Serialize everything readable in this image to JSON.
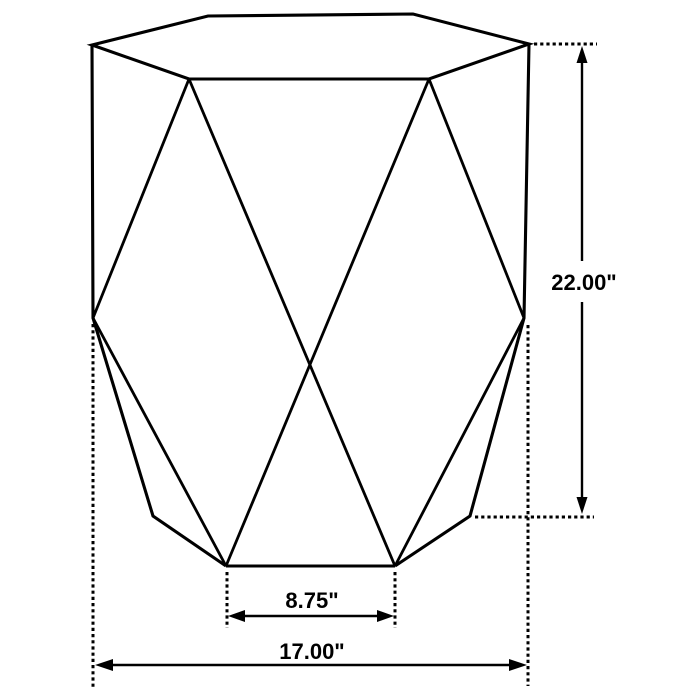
{
  "diagram": {
    "type": "product dimension drawing",
    "subject": "faceted hexagonal drum accent table wireframe"
  },
  "dimensions": {
    "height": {
      "label": "22.00\"",
      "value": 22.0,
      "unit": "inches"
    },
    "base_width": {
      "label": "8.75\"",
      "value": 8.75,
      "unit": "inches"
    },
    "overall_width": {
      "label": "17.00\"",
      "value": 17.0,
      "unit": "inches"
    }
  },
  "colors": {
    "line": "#000000",
    "background": "#ffffff"
  }
}
